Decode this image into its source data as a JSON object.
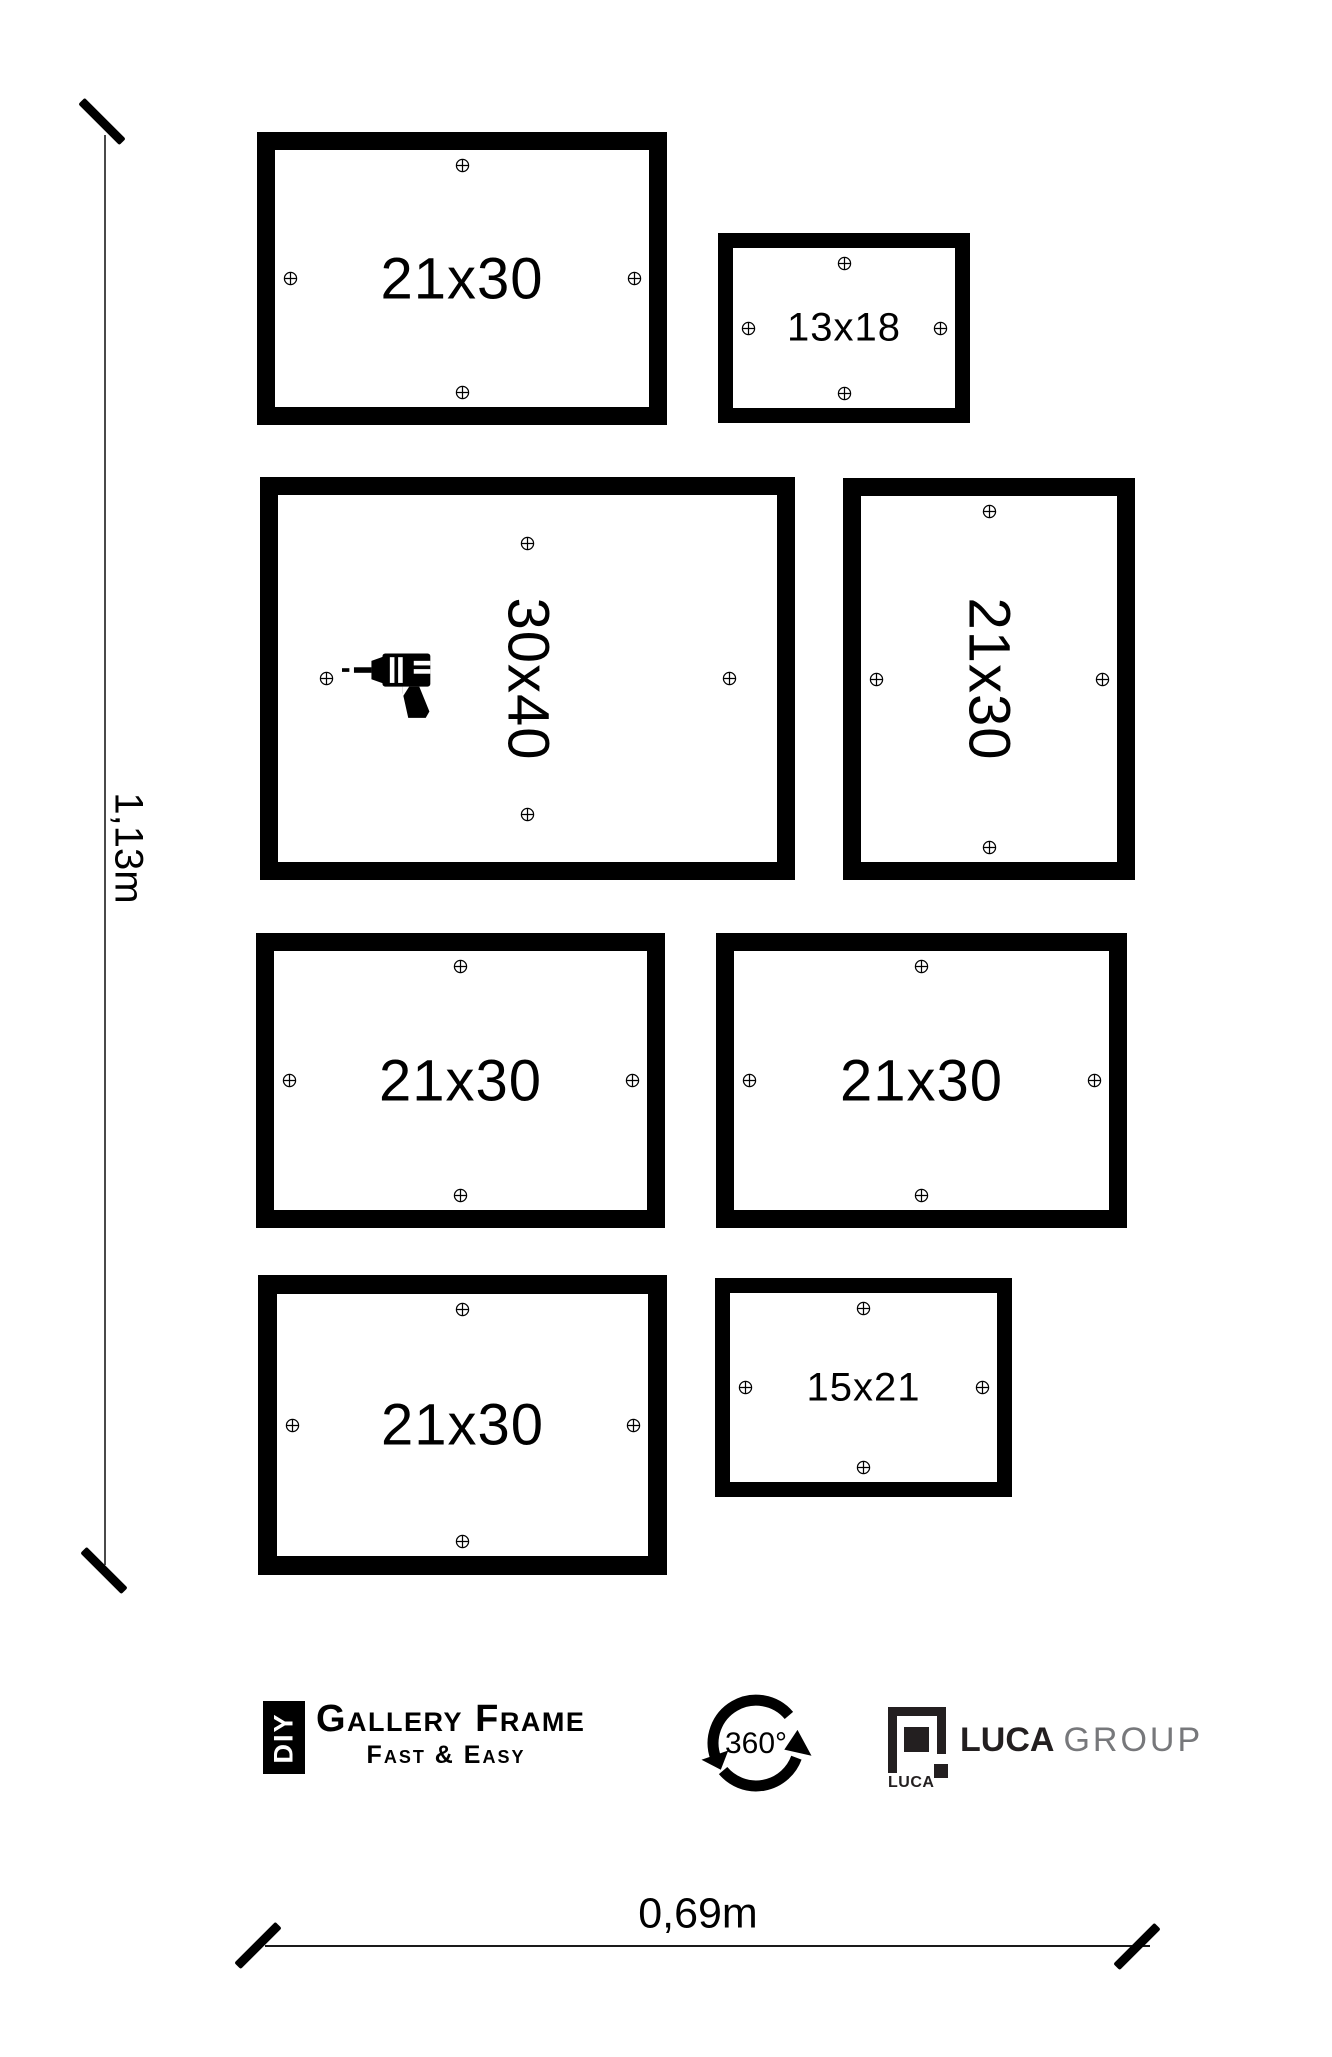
{
  "frames": [
    {
      "label": "21x30",
      "x": 257,
      "y": 132,
      "w": 410,
      "h": 293,
      "border": 18,
      "rotated": false,
      "small": false,
      "inset": 15,
      "drill": false
    },
    {
      "label": "13x18",
      "x": 718,
      "y": 233,
      "w": 252,
      "h": 190,
      "border": 15,
      "rotated": false,
      "small": true,
      "inset": 15,
      "drill": false
    },
    {
      "label": "30x40",
      "x": 260,
      "y": 477,
      "w": 535,
      "h": 403,
      "border": 18,
      "rotated": true,
      "small": false,
      "inset": 48,
      "drill": true
    },
    {
      "label": "21x30",
      "x": 843,
      "y": 478,
      "w": 292,
      "h": 402,
      "border": 18,
      "rotated": true,
      "small": false,
      "inset": 15,
      "drill": false
    },
    {
      "label": "21x30",
      "x": 256,
      "y": 933,
      "w": 409,
      "h": 295,
      "border": 18,
      "rotated": false,
      "small": false,
      "inset": 15,
      "drill": false
    },
    {
      "label": "21x30",
      "x": 716,
      "y": 933,
      "w": 411,
      "h": 295,
      "border": 18,
      "rotated": false,
      "small": false,
      "inset": 15,
      "drill": false
    },
    {
      "label": "21x30",
      "x": 258,
      "y": 1275,
      "w": 409,
      "h": 300,
      "border": 19,
      "rotated": false,
      "small": false,
      "inset": 15,
      "drill": false
    },
    {
      "label": "15x21",
      "x": 715,
      "y": 1278,
      "w": 297,
      "h": 219,
      "border": 15,
      "rotated": false,
      "small": true,
      "inset": 15,
      "drill": false
    }
  ],
  "dim_height": {
    "label": "1,13m"
  },
  "dim_width": {
    "label": "0,69m"
  },
  "branding": {
    "diy_label": "DIY",
    "name": "Gallery Frame",
    "tagline": "Fast & Easy",
    "rotation_label": "360°",
    "luca_icon_label": "LUCA",
    "luca_name_bold": "LUCA",
    "luca_name_light": "GROUP"
  },
  "colors": {
    "frame_border": "#000000",
    "group_text": "#77787b",
    "dim_line": "#4a4a4a"
  }
}
